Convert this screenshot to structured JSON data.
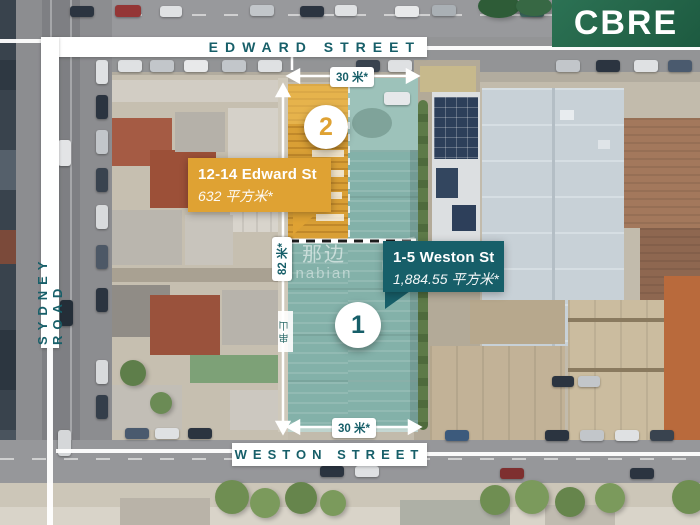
{
  "brand": {
    "name": "CBRE",
    "logo_bg": "#256a4c"
  },
  "streets": {
    "top": "EDWARD STREET",
    "left": "SYDNEY ROAD",
    "bottom": "WESTON STREET"
  },
  "dimensions": {
    "frontage_top": "30 米*",
    "frontage_bottom": "30 米*",
    "depth": "82 米*"
  },
  "lots": {
    "lot1": {
      "badge": "1",
      "address": "1-5 Weston St",
      "area": "1,884.55 平方米*",
      "accent": "#175f69"
    },
    "lot2": {
      "badge": "2",
      "address": "12-14 Edward St",
      "area": "632 平方米*",
      "accent": "#dfa233"
    }
  },
  "watermark": {
    "cn": "那边",
    "en": "nabian",
    "tag": "串山"
  }
}
